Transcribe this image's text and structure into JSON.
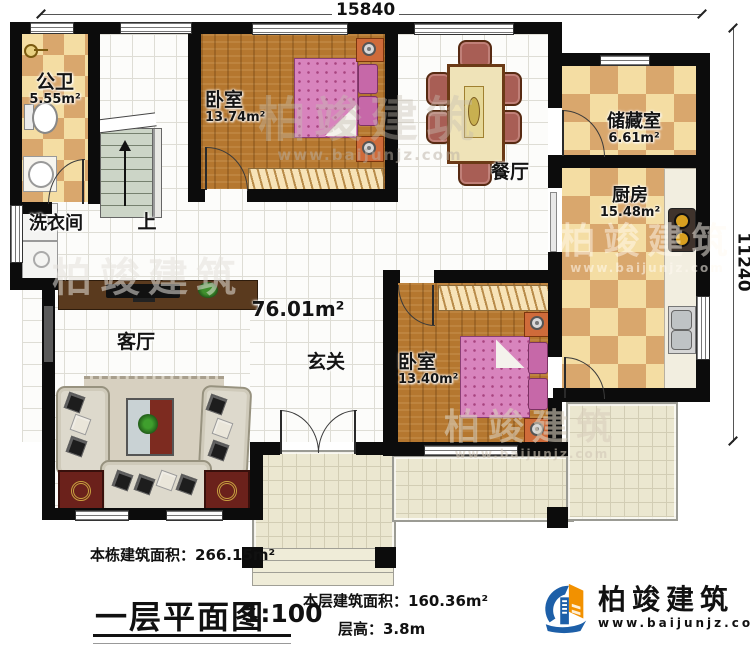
{
  "dimensions": {
    "top": "15840",
    "right": "11240"
  },
  "rooms": {
    "bathroom": {
      "label": "公卫",
      "area": "5.55m²"
    },
    "laundry": {
      "label": "洗衣间"
    },
    "stairs": {
      "label": "上"
    },
    "bedroom1": {
      "label": "卧室",
      "area": "13.74m²"
    },
    "dining": {
      "label": "餐厅"
    },
    "storage": {
      "label": "储藏室",
      "area": "6.61m²"
    },
    "kitchen": {
      "label": "厨房",
      "area": "15.48m²"
    },
    "living": {
      "label": "客厅"
    },
    "foyer": {
      "label": "玄关"
    },
    "bedroom2": {
      "label": "卧室",
      "area": "13.40m²"
    },
    "floor_area": "76.01m²"
  },
  "footer": {
    "building_area": "本栋建筑面积：266.15m²",
    "title": "一层平面图",
    "scale": "1:100",
    "floor_area": "本层建筑面积：160.36m²",
    "floor_height": "层高：3.8m"
  },
  "logo": {
    "name": "柏竣建筑",
    "url": "www.baijunjz.com"
  },
  "watermark": {
    "text": "柏竣建筑",
    "url": "www.baijunjz.com"
  },
  "colors": {
    "wall": "#0c0c0c",
    "wood": "#b5772f",
    "checker_light": "#f4dda3",
    "checker_dark": "#d9a76d",
    "bed_pink": "#d884bd",
    "terrace": "#ebe7d0",
    "logo_blue": "#1d5fa8",
    "logo_orange": "#f29100"
  }
}
